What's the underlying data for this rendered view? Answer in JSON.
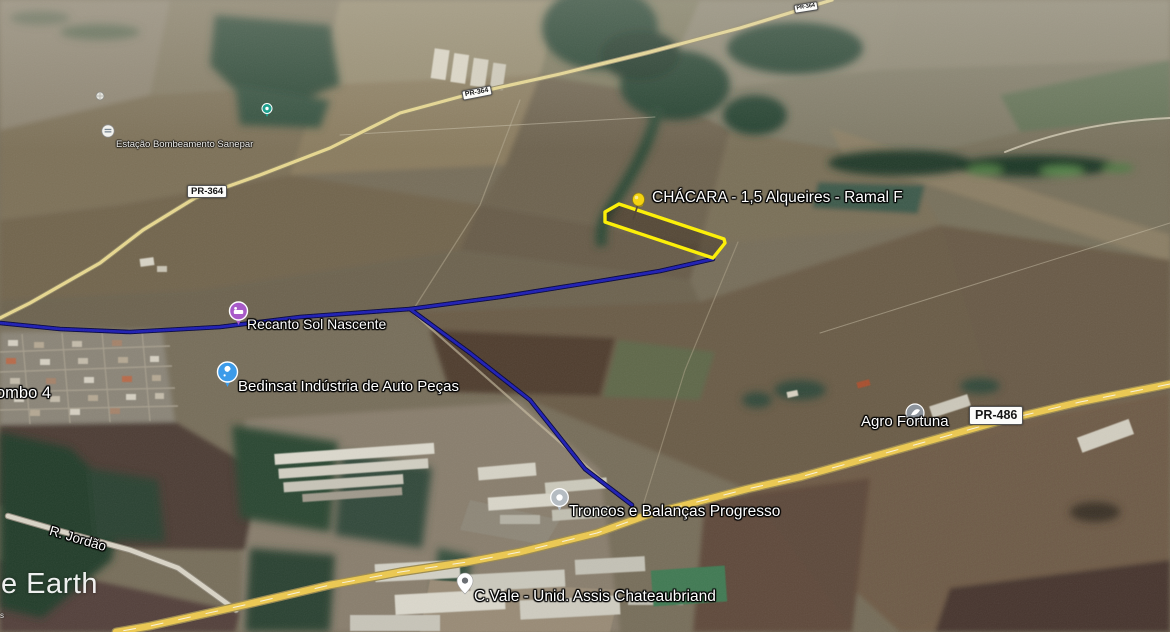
{
  "watermark": {
    "fragment": "e Earth"
  },
  "attribution": {
    "fragment": "s"
  },
  "parcel": {
    "label": "CHÁCARA - 1,5 Alqueires - Ramal F",
    "outline_color": "#fff200",
    "pushpin_icon": "yellow-pushpin-icon",
    "pushpin_color": "#f7d308"
  },
  "route": {
    "color": "#1c1cb4"
  },
  "places": [
    {
      "label": "Estação Bombeamento Sanepar",
      "icon": "pump-station-icon",
      "icon_color": "#f2f2ee"
    },
    {
      "label": "Recanto Sol Nascente",
      "icon": "lodging-icon",
      "icon_color": "#a85bc8"
    },
    {
      "label": "Bedinsat Indústria de Auto Peças",
      "icon": "auto-parts-icon",
      "icon_color": "#3c9be9"
    },
    {
      "label": "Agro Fortuna",
      "icon": "business-icon",
      "icon_color": "#8d949c"
    },
    {
      "label": "Troncos e Balanças Progresso",
      "icon": "poi-dot-icon",
      "icon_color": "#b5bcc2"
    },
    {
      "label": "C.Vale - Unid. Assis Chateaubriand",
      "icon": "map-pin-icon",
      "icon_color": "#ffffff"
    }
  ],
  "unlabeled_pois": [
    {
      "icon": "small-teal-poi-icon",
      "icon_color": "#1fa08e"
    },
    {
      "icon": "small-gray-poi-icon",
      "icon_color": "#e4e4de"
    }
  ],
  "road_shields": [
    {
      "label": "PR-364"
    },
    {
      "label": "PR-364"
    },
    {
      "label": "PR-364"
    },
    {
      "label": "PR-486"
    }
  ],
  "street": {
    "label": "R. Jordão"
  },
  "town": {
    "label_fragment": "ombo 4"
  }
}
